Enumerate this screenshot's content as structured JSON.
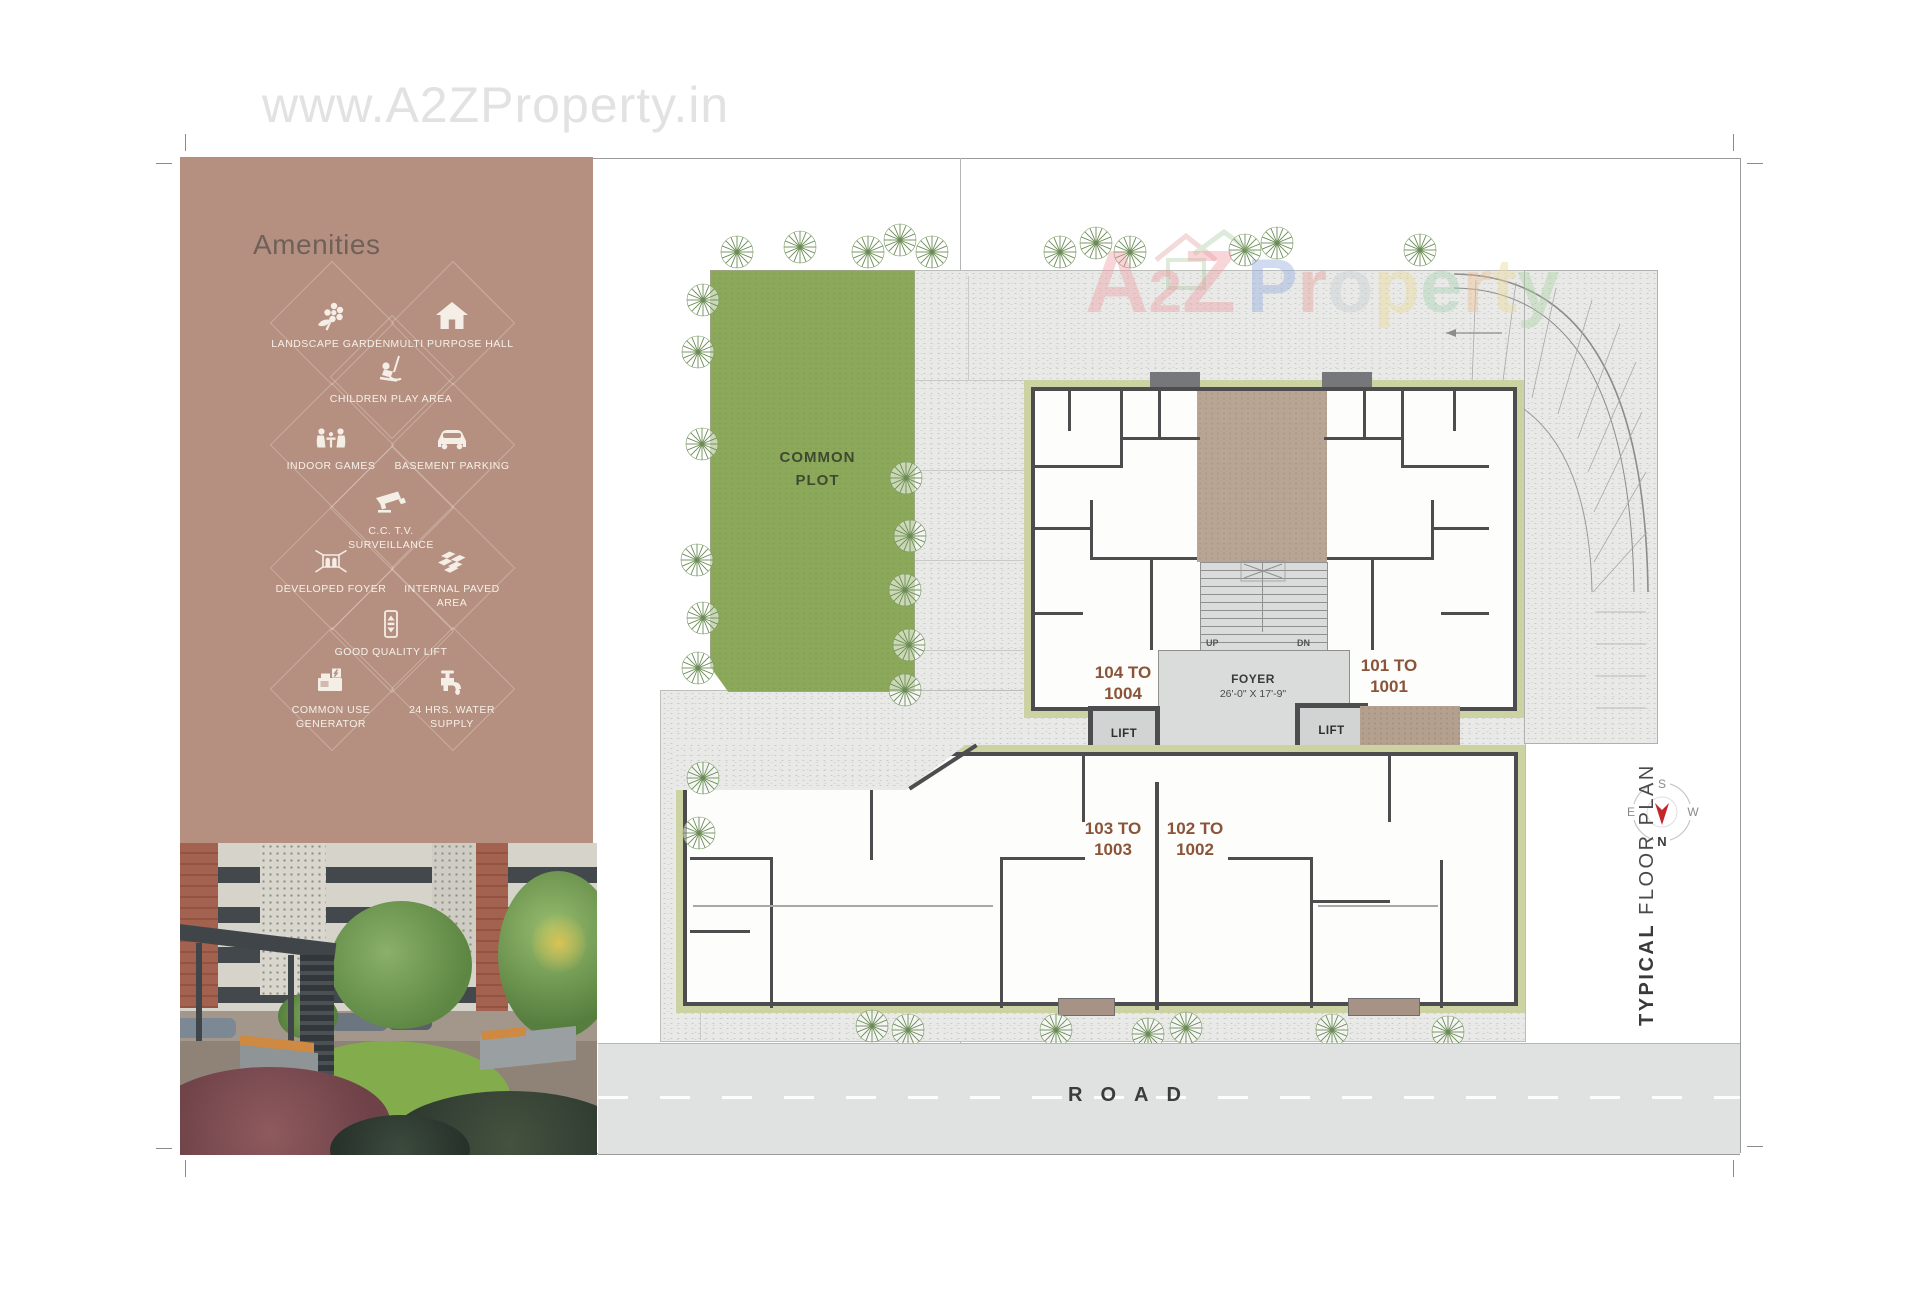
{
  "page": {
    "watermark": "www.A2ZProperty.in"
  },
  "brand": {
    "a2z_letters": [
      {
        "ch": "A",
        "style": "color:#ef9ca4;font-size:88px"
      },
      {
        "ch": "2",
        "style": "color:#ef9ca4;font-size:60px"
      },
      {
        "ch": "Z",
        "style": "color:#ef9ca4;font-size:88px"
      }
    ],
    "property_letters": [
      {
        "ch": "P",
        "style": "color:#92abdd"
      },
      {
        "ch": "r",
        "style": "color:#eb9d96"
      },
      {
        "ch": "o",
        "style": "color:#c9ced3"
      },
      {
        "ch": "p",
        "style": "color:#edd897"
      },
      {
        "ch": "e",
        "style": "color:#a6d0b0"
      },
      {
        "ch": "r",
        "style": "color:#eec092"
      },
      {
        "ch": "t",
        "style": "color:#ebd996"
      },
      {
        "ch": "y",
        "style": "color:#abd0a2"
      }
    ]
  },
  "amenities": {
    "heading": "Amenities",
    "items": [
      {
        "label": "LANDSCAPE GARDEN",
        "icon": "flower-icon"
      },
      {
        "label": "MULTI PURPOSE HALL",
        "icon": "house-icon"
      },
      {
        "label": "CHILDREN PLAY AREA",
        "icon": "swing-icon"
      },
      {
        "label": "INDOOR GAMES",
        "icon": "players-icon"
      },
      {
        "label": "BASEMENT PARKING",
        "icon": "car-icon"
      },
      {
        "label": "C.C. T.V. SURVEILLANCE",
        "icon": "cctv-icon"
      },
      {
        "label": "DEVELOPED FOYER",
        "icon": "foyer-icon"
      },
      {
        "label": "INTERNAL PAVED AREA",
        "icon": "tiles-icon"
      },
      {
        "label": "GOOD QUALITY LIFT",
        "icon": "lift-icon"
      },
      {
        "label": "COMMON USE GENERATOR",
        "icon": "generator-icon"
      },
      {
        "label": "24 HRS. WATER SUPPLY",
        "icon": "tap-icon"
      }
    ]
  },
  "site": {
    "common_plot": "COMMON PLOT",
    "road": "ROAD"
  },
  "plan": {
    "units": [
      {
        "line1": "104 TO",
        "line2": "1004"
      },
      {
        "line1": "101 TO",
        "line2": "1001"
      },
      {
        "line1": "103 TO",
        "line2": "1003"
      },
      {
        "line1": "102 TO",
        "line2": "1002"
      }
    ],
    "foyer_name": "FOYER",
    "foyer_dims": "26'-0\" X 17'-9\"",
    "lift_label": "LIFT",
    "up": "UP",
    "dn": "DN"
  },
  "compass": {
    "n": "N",
    "s": "S",
    "e": "E",
    "w": "W"
  },
  "caption": {
    "bold": "TYPICAL",
    "normal": " FLOOR PLAN"
  },
  "colors": {
    "panel": "#b59080",
    "common_plot_green": "#8ca95b",
    "olive_band": "#ccd2a2",
    "wall": "#4d4d4f",
    "courtyard_brown": "#b8a593",
    "unit_label_brown": "#8a5438",
    "compass_arrow_red": "#c4242b"
  }
}
